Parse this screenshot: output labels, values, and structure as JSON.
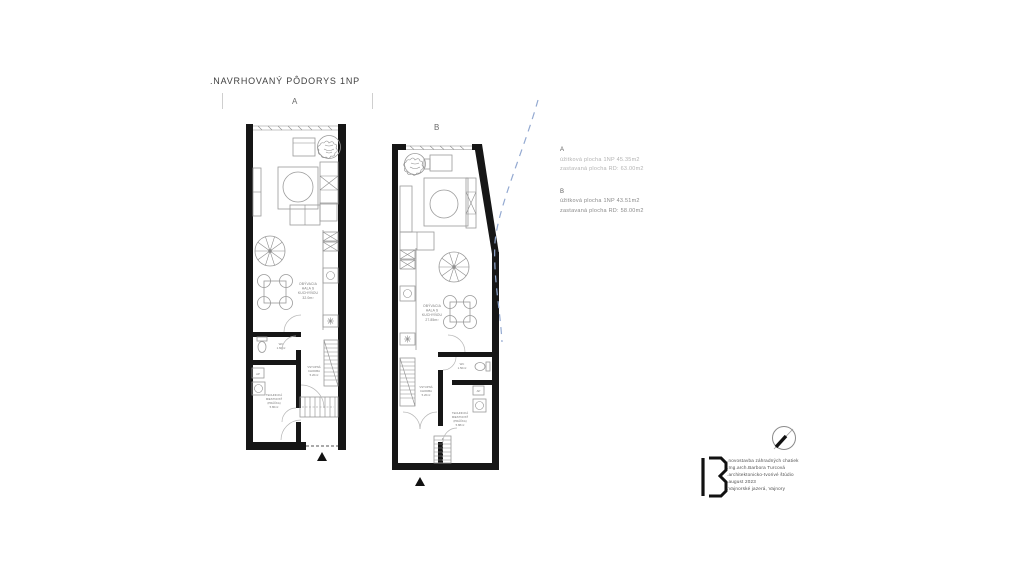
{
  "title": ".NAVRHOVANÝ PÔDORYS 1NP",
  "plan_a": {
    "label": "A",
    "living": [
      "OBÝVACIA",
      "HALA S",
      "KUCHYŇOU",
      "32.0m²"
    ],
    "wc": [
      "WC",
      "1.60m²"
    ],
    "ap": "AP",
    "tech": [
      "TECHNICKÁ",
      "MIESTNOSŤ",
      "(PRÁČKA)",
      "5.80m²"
    ],
    "hall": [
      "VSTUPNÁ",
      "CHODBA",
      "5.20m²"
    ]
  },
  "plan_b": {
    "label": "B",
    "living": [
      "OBÝVACIA",
      "HALA S",
      "KUCHYŇOU",
      "27.85m²"
    ],
    "wc": [
      "WC",
      "1.50m²"
    ],
    "ap": "AP",
    "tech": [
      "TECHNICKÁ",
      "MIESTNOSŤ",
      "(PRÁČKA)",
      "5.88m²"
    ],
    "hall": [
      "VSTUPNÁ",
      "CHODBA",
      "5.20m²"
    ]
  },
  "legend": {
    "a_label": "A",
    "a_line1": "úžitková plocha 1NP  45.35m2",
    "a_line2": "zastavaná plocha RD:  63.00m2",
    "b_label": "B",
    "b_line1": "úžitková plocha 1NP  43.51m2",
    "b_line2": "zastavaná plocha RD:  58.00m2"
  },
  "credits": {
    "lines": [
      ".novostavba záhradných chatiek",
      ".Ing.arch.Barbora Turcová",
      ".architektonicko-tvorivé štúdio",
      ".august 2023",
      ".Vajnorské jazerá, Vajnory"
    ]
  },
  "colors": {
    "wall": "#161616",
    "furniture": "#9a9a9a",
    "boundary": "#93a9d1",
    "label_text": "#7a7a7a"
  }
}
